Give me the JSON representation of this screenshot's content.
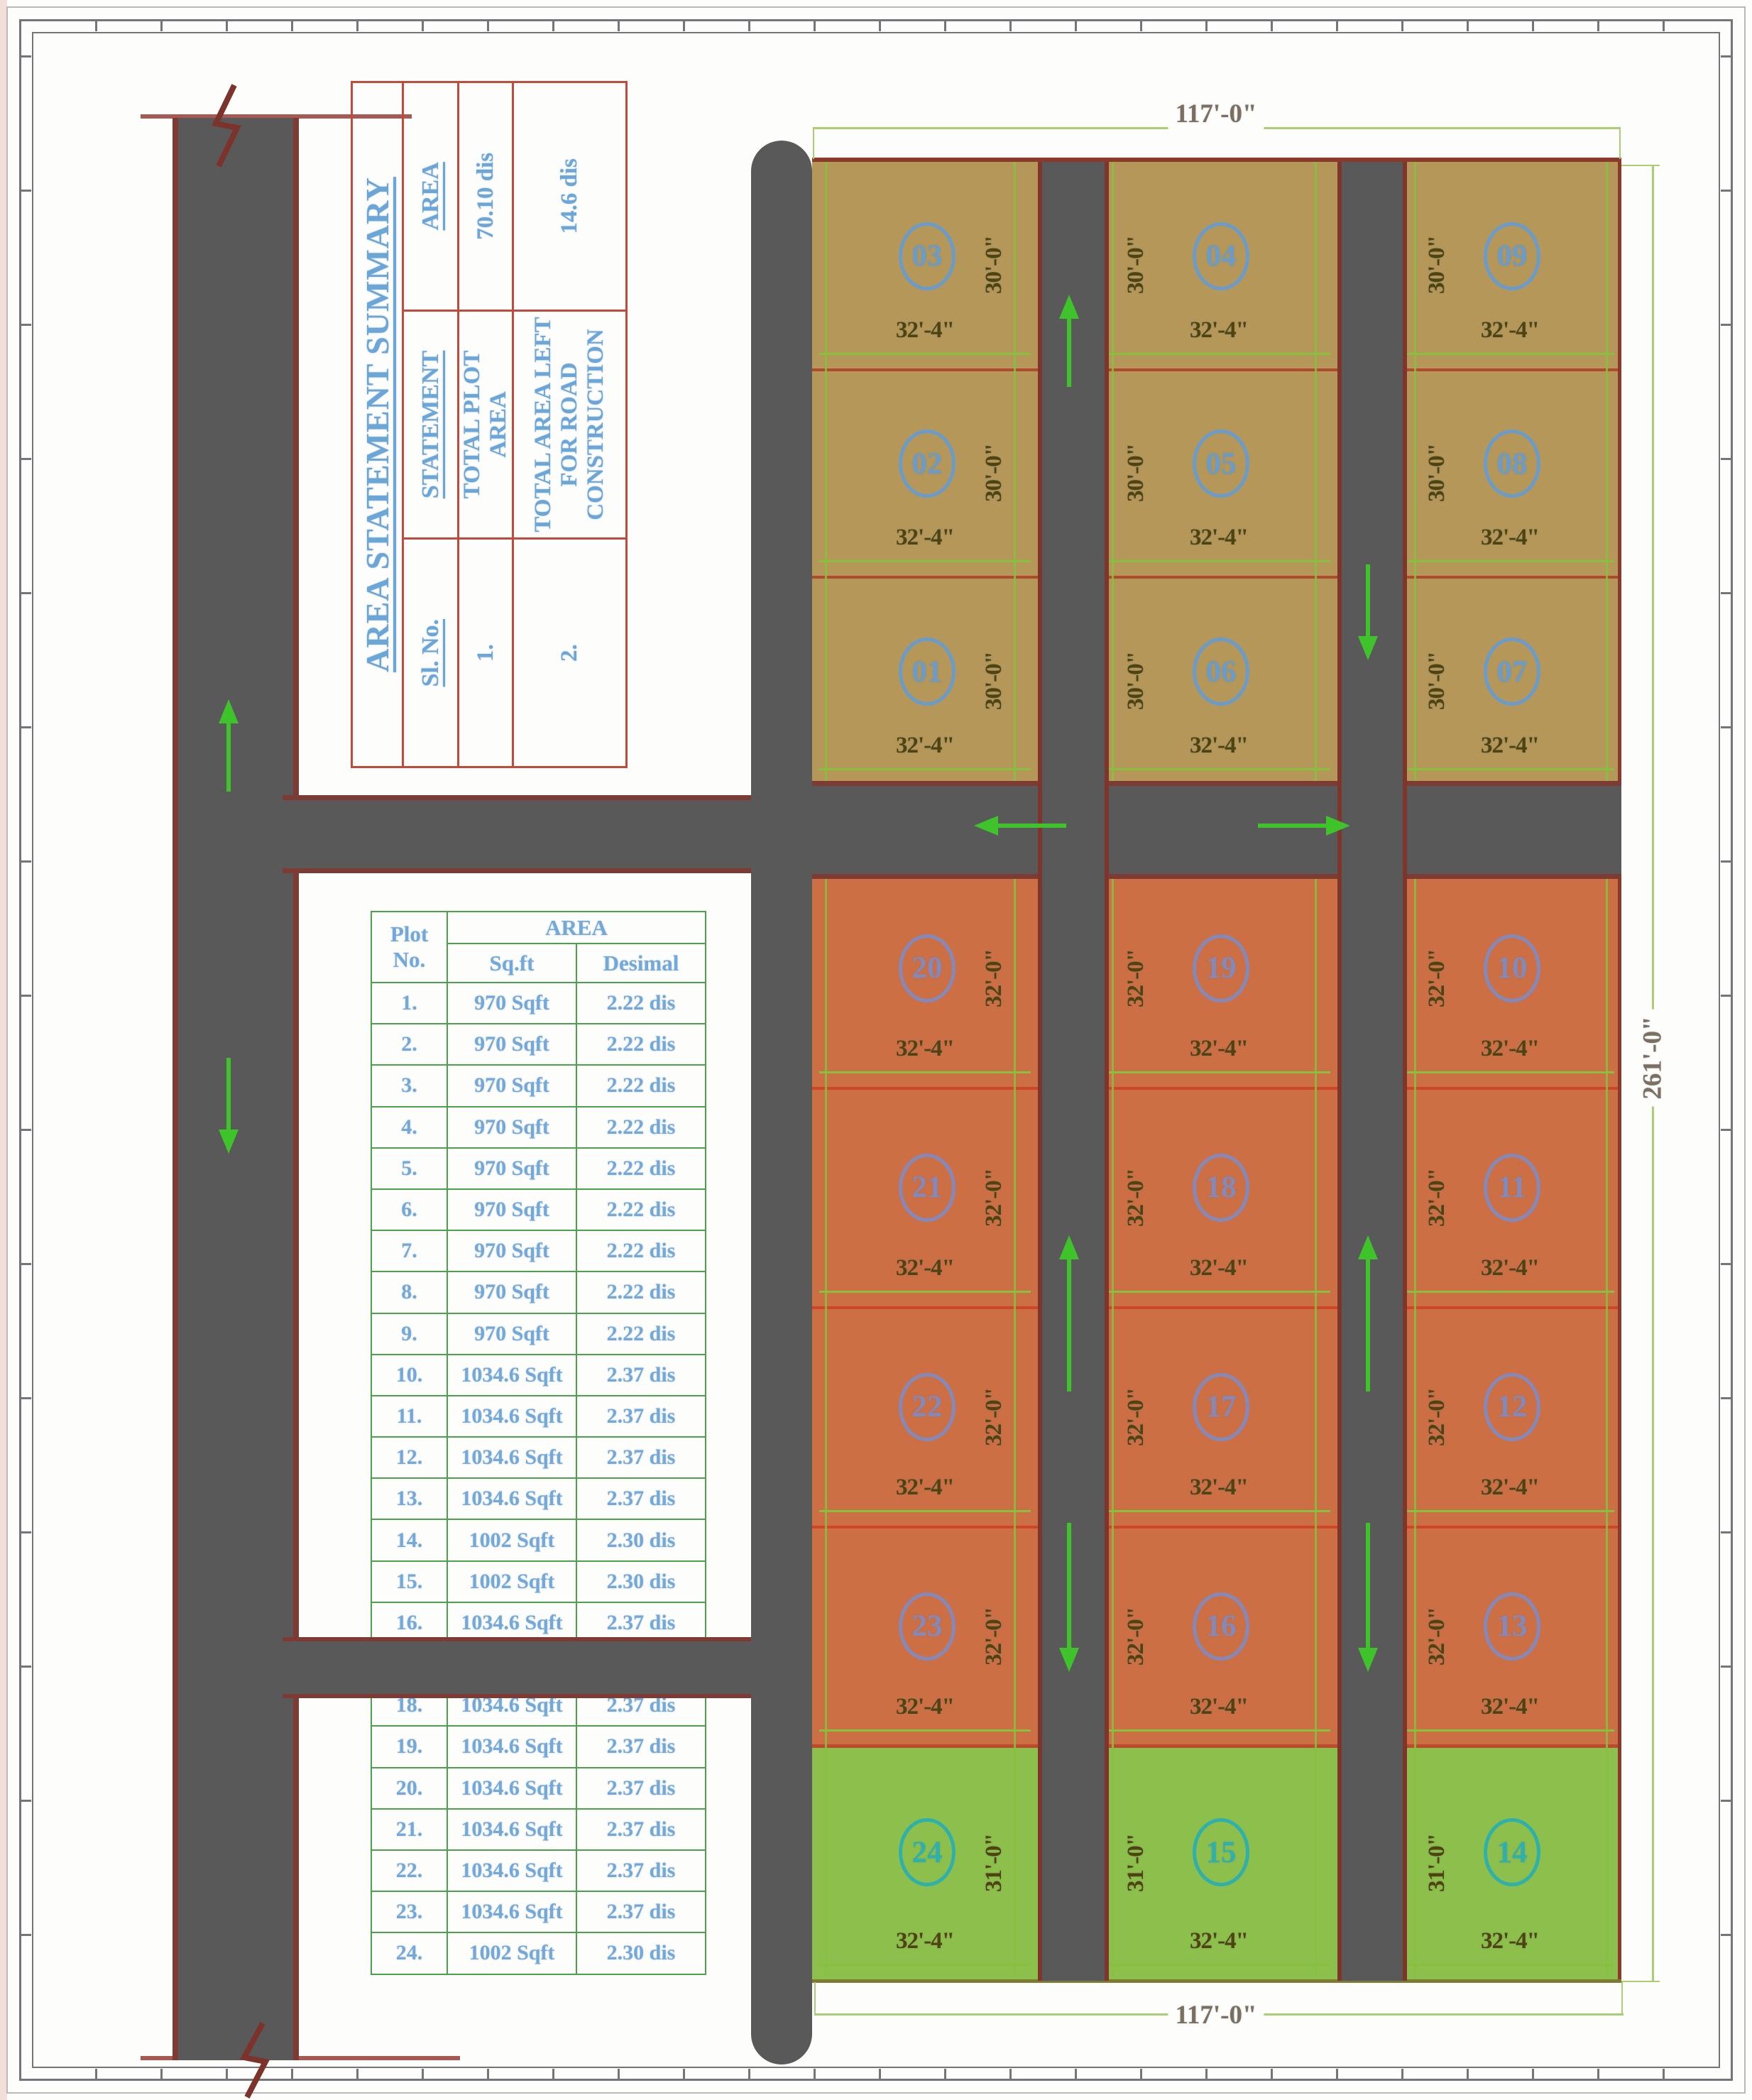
{
  "summary_table": {
    "title": "AREA STATEMENT SUMMARY",
    "headers": [
      "Sl. No.",
      "STATEMENT",
      "AREA"
    ],
    "rows": [
      {
        "sl_no": "1.",
        "statement": "TOTAL PLOT AREA",
        "area": "70.10 dis"
      },
      {
        "sl_no": "2.",
        "statement": "TOTAL AREA LEFT FOR ROAD CONSTRUCTION",
        "area": "14.6 dis"
      }
    ],
    "border_color": "#c14a3c",
    "text_color": "#6aa6d8"
  },
  "plot_table": {
    "col_headers": {
      "plot_no": "Plot No.",
      "area_group": "AREA",
      "sqft": "Sq.ft",
      "desimal": "Desimal"
    },
    "rows": [
      {
        "no": "1.",
        "sqft": "970 Sqft",
        "desimal": "2.22 dis"
      },
      {
        "no": "2.",
        "sqft": "970 Sqft",
        "desimal": "2.22 dis"
      },
      {
        "no": "3.",
        "sqft": "970 Sqft",
        "desimal": "2.22 dis"
      },
      {
        "no": "4.",
        "sqft": "970 Sqft",
        "desimal": "2.22 dis"
      },
      {
        "no": "5.",
        "sqft": "970 Sqft",
        "desimal": "2.22 dis"
      },
      {
        "no": "6.",
        "sqft": "970 Sqft",
        "desimal": "2.22 dis"
      },
      {
        "no": "7.",
        "sqft": "970 Sqft",
        "desimal": "2.22 dis"
      },
      {
        "no": "8.",
        "sqft": "970 Sqft",
        "desimal": "2.22 dis"
      },
      {
        "no": "9.",
        "sqft": "970 Sqft",
        "desimal": "2.22 dis"
      },
      {
        "no": "10.",
        "sqft": "1034.6 Sqft",
        "desimal": "2.37 dis"
      },
      {
        "no": "11.",
        "sqft": "1034.6 Sqft",
        "desimal": "2.37 dis"
      },
      {
        "no": "12.",
        "sqft": "1034.6 Sqft",
        "desimal": "2.37 dis"
      },
      {
        "no": "13.",
        "sqft": "1034.6 Sqft",
        "desimal": "2.37 dis"
      },
      {
        "no": "14.",
        "sqft": "1002 Sqft",
        "desimal": "2.30 dis"
      },
      {
        "no": "15.",
        "sqft": "1002 Sqft",
        "desimal": "2.30 dis"
      },
      {
        "no": "16.",
        "sqft": "1034.6 Sqft",
        "desimal": "2.37 dis"
      },
      {
        "no": "17.",
        "sqft": "1034.6 Sqft",
        "desimal": "2.37 dis"
      },
      {
        "no": "18.",
        "sqft": "1034.6 Sqft",
        "desimal": "2.37 dis"
      },
      {
        "no": "19.",
        "sqft": "1034.6 Sqft",
        "desimal": "2.37 dis"
      },
      {
        "no": "20.",
        "sqft": "1034.6 Sqft",
        "desimal": "2.37 dis"
      },
      {
        "no": "21.",
        "sqft": "1034.6 Sqft",
        "desimal": "2.37 dis"
      },
      {
        "no": "22.",
        "sqft": "1034.6 Sqft",
        "desimal": "2.37 dis"
      },
      {
        "no": "23.",
        "sqft": "1034.6 Sqft",
        "desimal": "2.37 dis"
      },
      {
        "no": "24.",
        "sqft": "1002 Sqft",
        "desimal": "2.30 dis"
      }
    ],
    "border_color": "#4aa34a",
    "text_color": "#73a9d9"
  },
  "site_plan": {
    "dimensions": {
      "top": "117'-0\"",
      "bottom": "117'-0\"",
      "right": "261'-0\""
    },
    "plot_width_label": "32'-4\"",
    "sections": [
      {
        "name": "north-block",
        "fill": "#b49759",
        "divider_color": "#b14a2d",
        "circle_color": "#6b9cc9",
        "height_label": "30'-0\"",
        "rows": [
          [
            "03",
            "04",
            "09"
          ],
          [
            "02",
            "05",
            "08"
          ],
          [
            "01",
            "06",
            "07"
          ]
        ]
      },
      {
        "name": "middle-block",
        "fill": "#cd6f45",
        "divider_color": "#cf4527",
        "circle_color": "#8489ba",
        "height_label": "32'-0\"",
        "rows": [
          [
            "20",
            "19",
            "10"
          ],
          [
            "21",
            "18",
            "11"
          ],
          [
            "22",
            "17",
            "12"
          ],
          [
            "23",
            "16",
            "13"
          ]
        ]
      },
      {
        "name": "south-block",
        "fill": "#8cbf4b",
        "divider_color": "#bc4a2c",
        "circle_color": "#2fb0ab",
        "height_label": "31'-0\"",
        "rows": [
          [
            "24",
            "15",
            "14"
          ]
        ]
      }
    ],
    "road_color": "#59595a",
    "arrow_color": "#3fc32a",
    "dim_line_color": "#86c13d"
  }
}
